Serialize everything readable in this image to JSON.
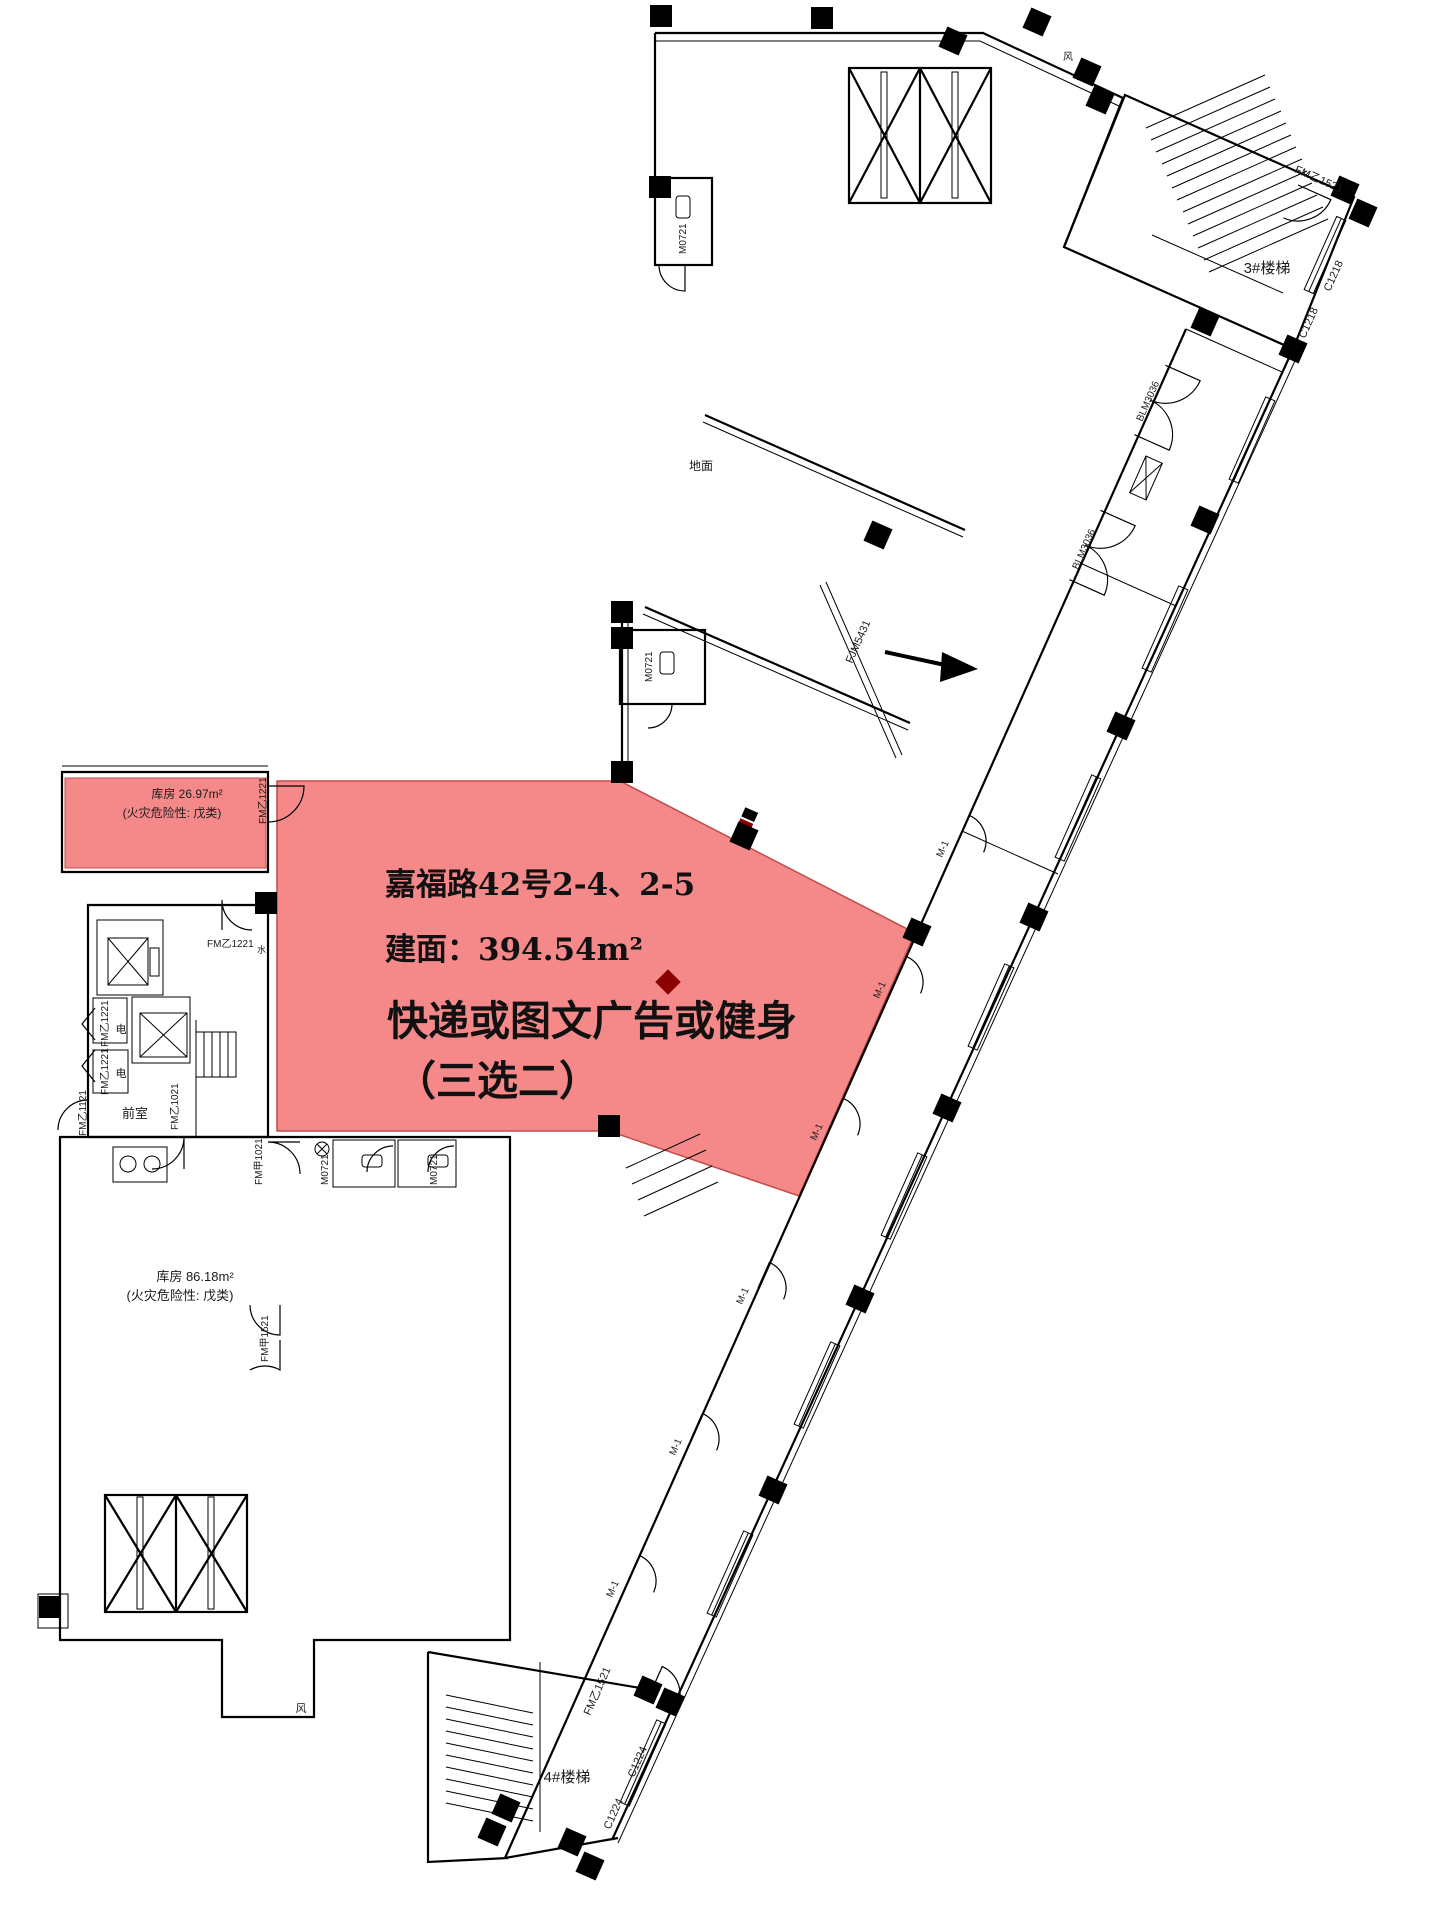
{
  "unit": {
    "address": "嘉福路42号2-4、2-5",
    "area": "建面：394.54m²",
    "usage": "快递或图文广告或健身",
    "note": "（三选二）"
  },
  "rooms": {
    "storage_small": "库房 26.97m²",
    "storage_large": "库房 86.18m²",
    "hazard_note": "(火灾危险性: 戊类)",
    "stair3": "3#楼梯",
    "stair4": "4#楼梯",
    "front": "前室",
    "ground": "地面"
  },
  "labels": {
    "m1": "M-1",
    "m0721": "M0721",
    "c1218": "C1218",
    "c1224": "C1224",
    "blm3036": "BLM3036",
    "fjm5431": "FJM5431",
    "fm_yi1521": "FM乙1521",
    "fm_yi1221": "FM乙1221",
    "fm_yi1121": "FM乙1121",
    "fm_yi1021": "FM乙1021",
    "fm_jia1021": "FM甲1021",
    "fm_jia1521": "FM甲1521",
    "dian": "电",
    "feng": "风",
    "shui": "水"
  },
  "colors": {
    "highlight": "#f58989",
    "highlight_edge": "#c24b4b",
    "dark_red": "#8b0000",
    "wall": "#000000",
    "background": "#ffffff"
  }
}
